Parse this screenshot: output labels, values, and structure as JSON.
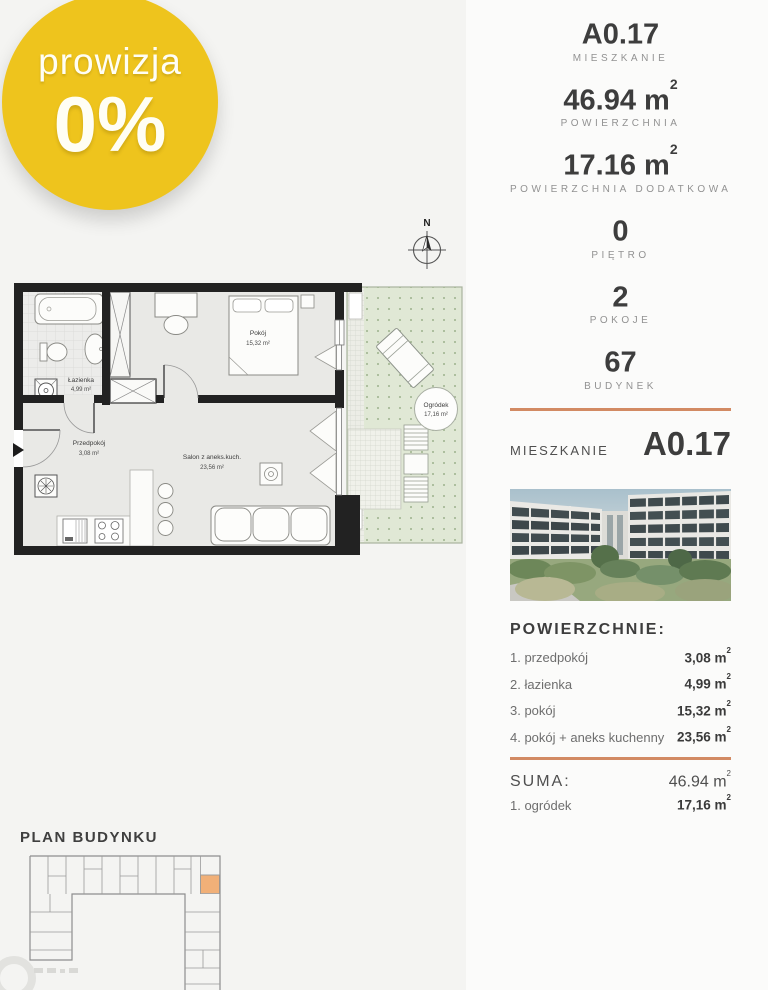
{
  "badge": {
    "line1": "prowizja",
    "line2": "0%"
  },
  "compass": {
    "label": "N"
  },
  "plan": {
    "bathroom": {
      "name": "Łazienka",
      "area": "4,99 m²"
    },
    "bedroom": {
      "name": "Pokój",
      "area": "15,32 m²"
    },
    "hall": {
      "name": "Przedpokój",
      "area": "3,08 m²"
    },
    "living": {
      "name": "Salon z aneks.kuch.",
      "area": "23,56 m²"
    },
    "garden": {
      "name": "Ogródek",
      "area": "17,16 m²"
    }
  },
  "stats": [
    {
      "value": "A0.17",
      "sup": "",
      "label": "MIESZKANIE"
    },
    {
      "value": "46.94 m",
      "sup": "2",
      "label": "POWIERZCHNIA"
    },
    {
      "value": "17.16 m",
      "sup": "2",
      "label": "POWIERZCHNIA DODATKOWA"
    },
    {
      "value": "0",
      "sup": "",
      "label": "PIĘTRO"
    },
    {
      "value": "2",
      "sup": "",
      "label": "POKOJE"
    },
    {
      "value": "67",
      "sup": "",
      "label": "BUDYNEK"
    }
  ],
  "unit_header": {
    "label": "MIESZKANIE",
    "value": "A0.17"
  },
  "areas": {
    "title": "POWIERZCHNIE:",
    "rows": [
      {
        "name": "1. przedpokój",
        "value": "3,08 m",
        "sup": "2"
      },
      {
        "name": "2. łazienka",
        "value": "4,99 m",
        "sup": "2"
      },
      {
        "name": "3. pokój",
        "value": "15,32 m",
        "sup": "2"
      },
      {
        "name": "4. pokój + aneks kuchenny",
        "value": "23,56 m",
        "sup": "2"
      }
    ],
    "suma": {
      "label": "SUMA:",
      "value": "46.94 m",
      "sup": "2"
    },
    "extra": {
      "name": "1. ogródek",
      "value": "17,16 m",
      "sup": "2"
    }
  },
  "building_plan": {
    "title": "PLAN BUDYNKU"
  },
  "colors": {
    "badge_bg": "#eec41d",
    "accent_divider": "#d28a63",
    "highlighted_unit": "#f1b078",
    "garden_green": "#e0e8d5",
    "wall_black": "#222222"
  }
}
